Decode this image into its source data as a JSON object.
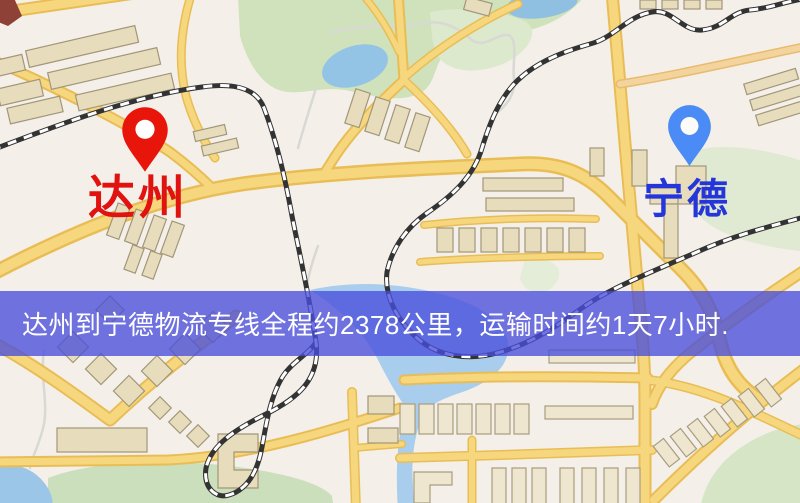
{
  "map": {
    "type": "street-map-illustration",
    "markers": [
      {
        "id": "origin",
        "label": "达州",
        "pin_color": "#e8150b",
        "label_color": "#e01310"
      },
      {
        "id": "destination",
        "label": "宁德",
        "pin_color": "#4b8bf5",
        "label_color": "#2435d9"
      }
    ]
  },
  "banner": {
    "text": "达州到宁德物流专线全程约2378公里，运输时间约1天7小时.",
    "bg_color": "rgba(73,78,219,0.78)",
    "text_color": "#ffffff"
  },
  "route": {
    "origin": "达州",
    "destination": "宁德",
    "distance_text": "约2378公里",
    "duration_text": "约1天7小时"
  },
  "palette": {
    "background": "#f4f0e9",
    "road_fill": "#f7d77e",
    "road_casing": "#e9bd55",
    "road_orange": "#f3d49c",
    "park_green": "#cfe2bb",
    "pale_green": "#e0ead2",
    "water_blue": "#93c4e6",
    "railway_dark": "#333333",
    "building_fill": "#e7ddbc"
  }
}
